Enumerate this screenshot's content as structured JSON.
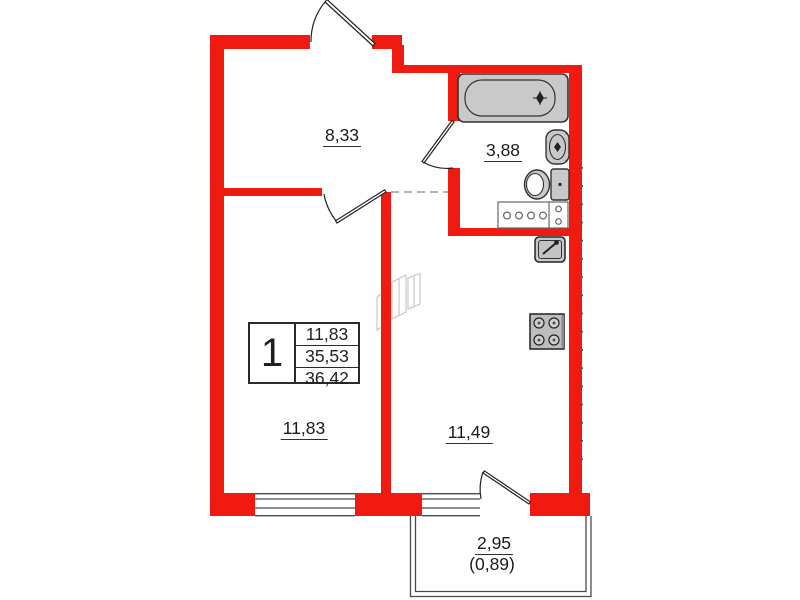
{
  "plan": {
    "type": "apartment-floor-plan",
    "rooms": {
      "hallway": {
        "area": "8,33"
      },
      "bathroom": {
        "area": "3,88"
      },
      "bedroom": {
        "area": "11,83"
      },
      "kitchen_living": {
        "area": "11,49"
      }
    },
    "balcony": {
      "area": "2,95",
      "reduced_area": "(0,89)"
    },
    "table": {
      "number": "1",
      "rows": [
        "11,83",
        "35,53",
        "36,42"
      ]
    },
    "icons": [
      "bathtub-icon",
      "bathroom-sink-icon",
      "toilet-icon",
      "washer-cabinet-icon",
      "kitchen-sink-icon",
      "stove-icon",
      "entrance-door-icon",
      "bedroom-door-icon",
      "bathroom-door-icon",
      "balcony-door-icon"
    ],
    "colors": {
      "wall_red": "#f01a11",
      "fixture_gray": "#c9c9c9",
      "line_dark": "#333333",
      "thin_line": "#4a4a4a",
      "watermark": "#c4c4c4"
    }
  }
}
